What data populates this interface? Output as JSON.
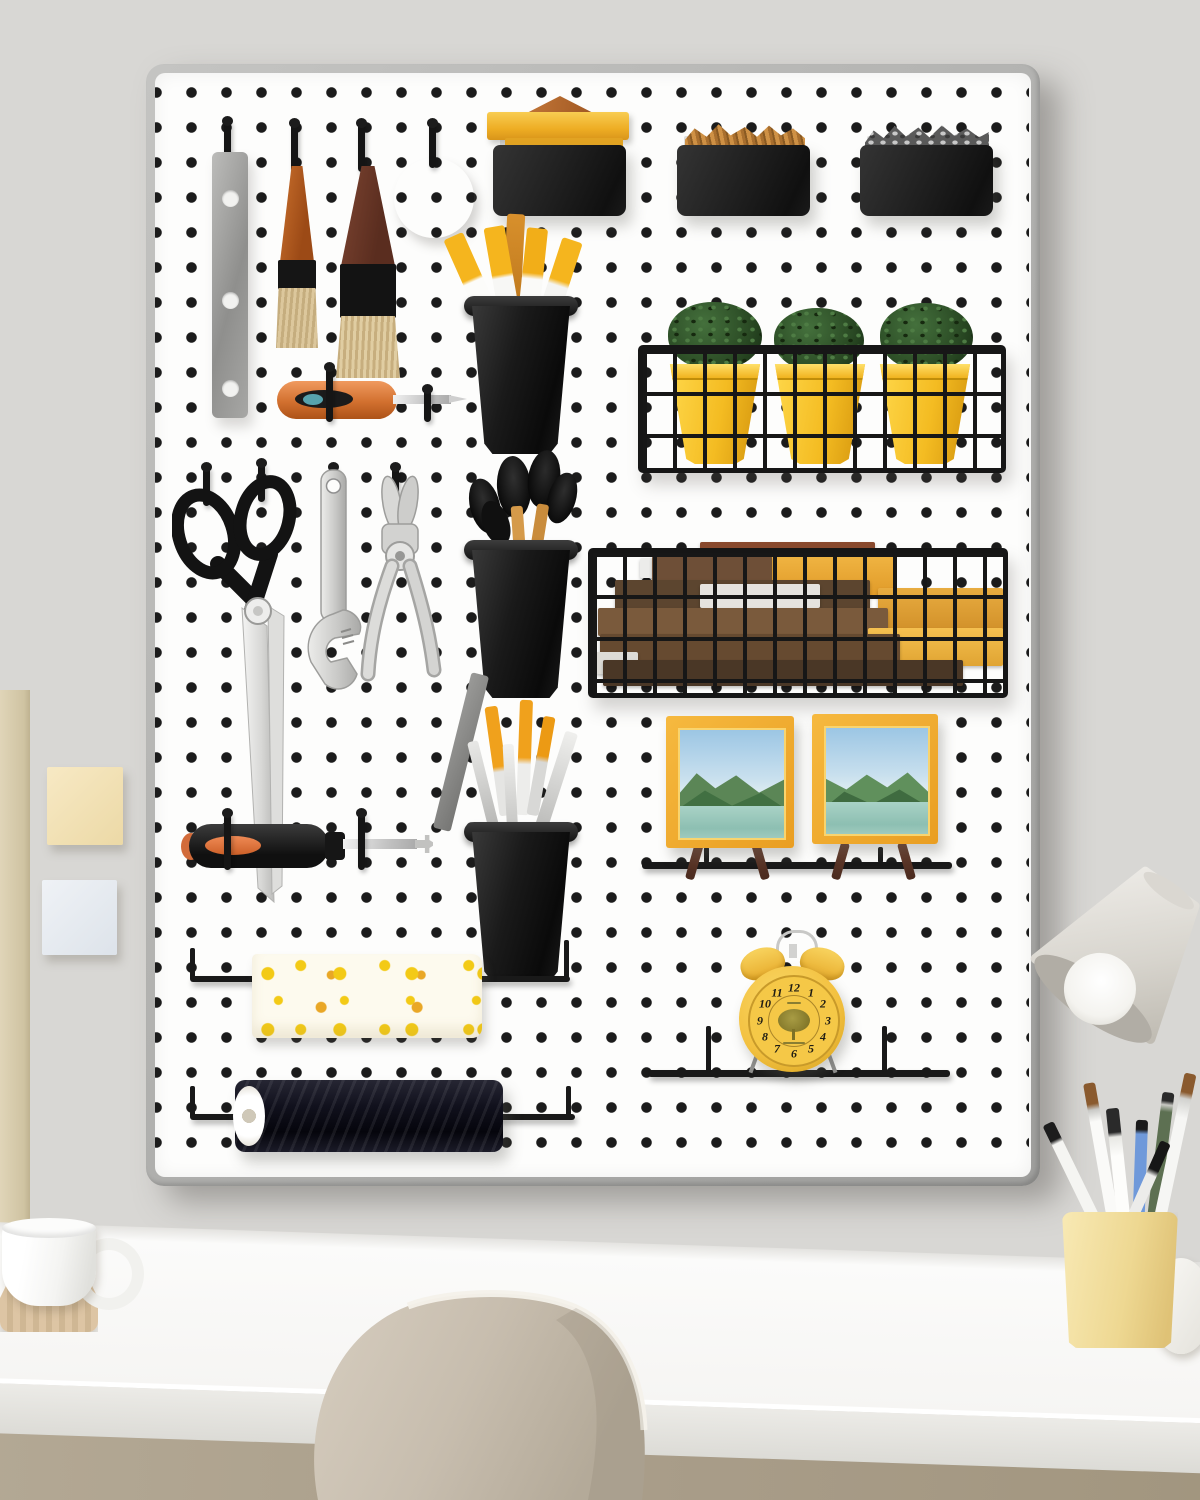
{
  "scene": {
    "type": "photograph",
    "subject": "White pegboard wall organizer with tools and craft supplies mounted above a white desk",
    "wall_color": "#e7e6e3",
    "desk_color": "#f8f7f5",
    "under_desk_color": "#a89c88",
    "chair_color": "#c9c0b1"
  },
  "pegboard": {
    "board_color": "#fdfdfc",
    "frame_color": "#b2b2b0",
    "hole_color": "#1b1b1b",
    "hook_color": "#151515",
    "accent_yellow": "#f2bb2e",
    "accent_copper": "#a85a2c"
  },
  "items": [
    {
      "id": "metal-ruler",
      "label": "metal hanging strip",
      "color": "#a3a3a3"
    },
    {
      "id": "paint-brush-small",
      "label": "small paint brush",
      "handle_color": "#b05a1f"
    },
    {
      "id": "paint-brush-large",
      "label": "wide paint brush",
      "handle_color": "#6e3c2b"
    },
    {
      "id": "tape-roll",
      "label": "roll of tape",
      "color": "#a85a2c"
    },
    {
      "id": "bin-yellow-boxes",
      "label": "black bin with yellow boxes on top",
      "color": "#1f1f1f"
    },
    {
      "id": "bin-wooden-sticks",
      "label": "black bin with wooden sticks",
      "color": "#1f1f1f"
    },
    {
      "id": "bin-screws",
      "label": "black bin with silver screws",
      "color": "#1f1f1f"
    },
    {
      "id": "cup-chalk",
      "label": "black cup with yellow markers",
      "color": "#171717"
    },
    {
      "id": "screwdriver-orange",
      "label": "orange screwdriver",
      "color": "#d2702f"
    },
    {
      "id": "basket-plants",
      "label": "wire basket with three yellow plant pots",
      "pot_color": "#f4bc22"
    },
    {
      "id": "scissors",
      "label": "tailor scissors",
      "color": "#141414"
    },
    {
      "id": "wrench",
      "label": "adjustable wrench",
      "color": "#c9c9c9"
    },
    {
      "id": "pliers",
      "label": "pliers",
      "color": "#c9c9c9"
    },
    {
      "id": "cup-brushes",
      "label": "black cup with makeup brushes",
      "color": "#171717"
    },
    {
      "id": "basket-books",
      "label": "wire basket with books",
      "book_colors": [
        "#6e4f37",
        "#ececea",
        "#eaa838"
      ]
    },
    {
      "id": "cup-pens",
      "label": "black cup with pens and pencils",
      "color": "#171717"
    },
    {
      "id": "picture-frames",
      "label": "two yellow framed landscape photos on easels",
      "frame_color": "#f0a92f"
    },
    {
      "id": "alarm-clock",
      "label": "yellow twin-bell alarm clock on rail shelf",
      "color": "#f3c64a"
    },
    {
      "id": "fabric-roll",
      "label": "rolled fabric with yellow flower print",
      "color": "#fdfaee"
    },
    {
      "id": "thread-spool",
      "label": "large black thread spool on rod",
      "color": "#14141c"
    }
  ],
  "clock": {
    "body_color": "#f3c64a",
    "motif": "tree",
    "numerals": [
      "12",
      "1",
      "2",
      "3",
      "4",
      "5",
      "6",
      "7",
      "8",
      "9",
      "10",
      "11"
    ]
  },
  "wall_objects": [
    {
      "id": "sticky-note-yellow",
      "color": "#f2e3bb"
    },
    {
      "id": "sticky-note-blue",
      "color": "#e9edf2"
    },
    {
      "id": "side-panel",
      "color": "#d9cdaf"
    }
  ],
  "desk_objects": [
    {
      "id": "white-mug",
      "label": "white mug on wooden coaster"
    },
    {
      "id": "pencil-cup",
      "label": "pale yellow cup with paint brushes and pencils",
      "color": "#f0dd9e"
    },
    {
      "id": "desk-lamp",
      "label": "white desk lamp shade",
      "color": "#dcd9d3"
    },
    {
      "id": "chair",
      "label": "beige shell chair"
    }
  ]
}
